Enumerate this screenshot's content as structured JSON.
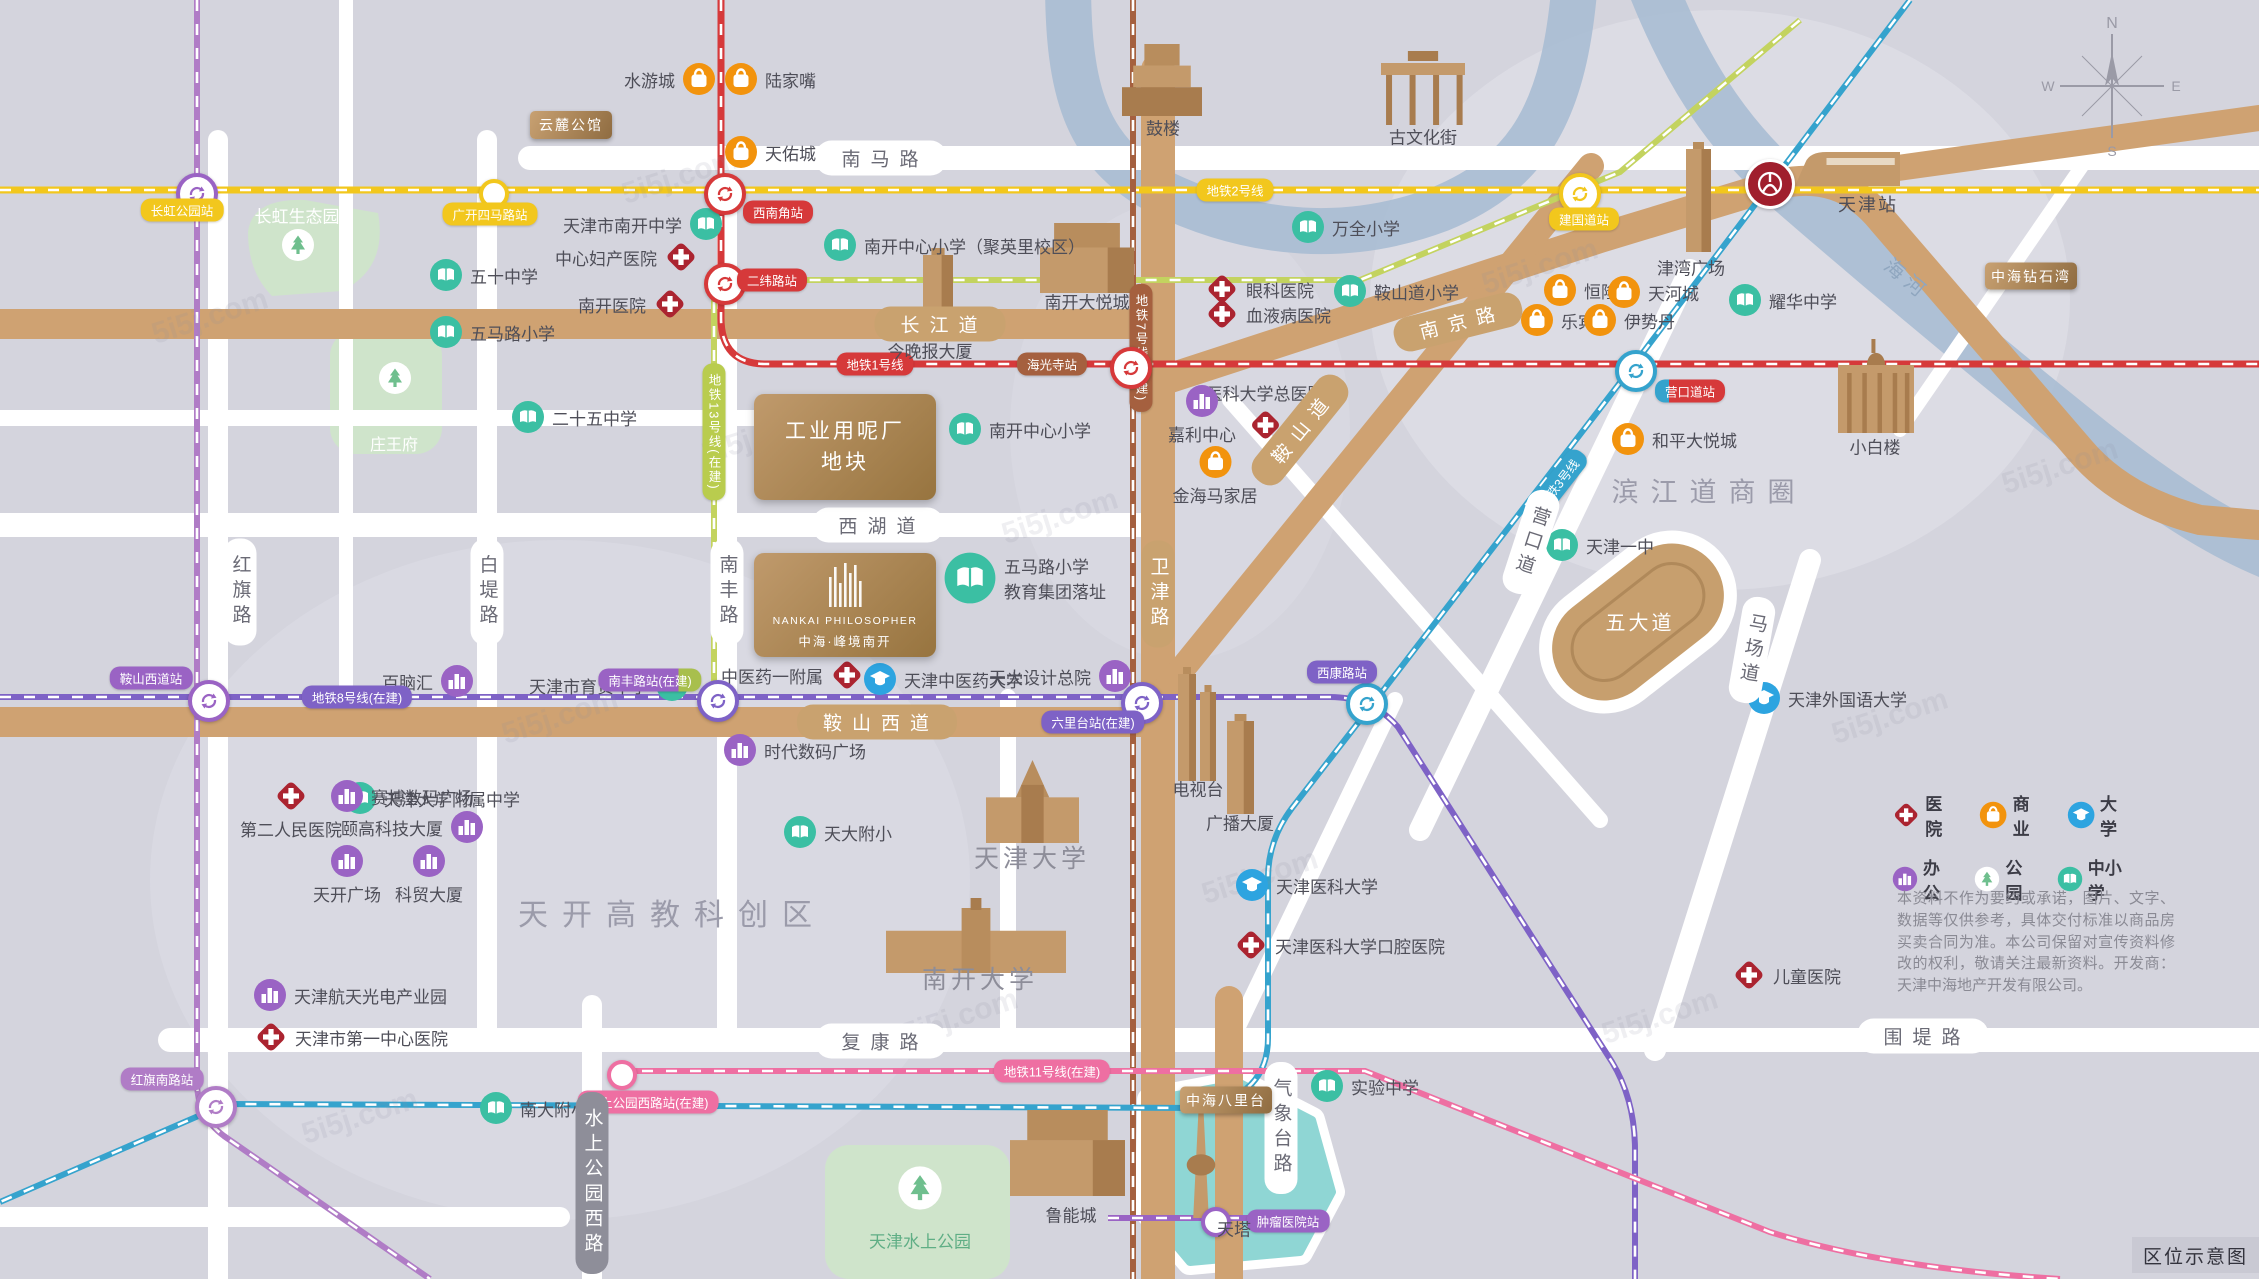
{
  "map": {
    "corner_label": "区位示意图",
    "watermark": "5i5j.com",
    "compass": {
      "x": 2112,
      "y": 86,
      "dirs": [
        "N",
        "W",
        "E",
        "S"
      ]
    },
    "legend": {
      "rows": [
        [
          {
            "icon": "hosp",
            "label": "医院"
          },
          {
            "icon": "shop",
            "label": "商业"
          },
          {
            "icon": "univ",
            "label": "大学"
          }
        ],
        [
          {
            "icon": "office",
            "label": "办公"
          },
          {
            "icon": "park",
            "label": "公园"
          },
          {
            "icon": "school",
            "label": "中小学"
          }
        ]
      ]
    },
    "disclaimer": "本资料不作为要约或承诺，图片、文字、数据等仅供参考，具体交付标准以商品房买卖合同为准。本公司保留对宣传资料修改的权利，敬请关注最新资料。开发商：天津中海地产开发有限公司。",
    "colors": {
      "line1": "#d6393a",
      "line2": "#f2c71d",
      "line3": "#35a3cd",
      "line7": "#a5603f",
      "line8": "#7e62c6",
      "line6": "#b07cc6",
      "line11": "#ee6fa2",
      "line13": "#b9cc4e",
      "school": "#3bbfa3",
      "univ": "#2da4e0",
      "hosp": "#ab2430",
      "office": "#9a63c4",
      "shop": "#f2930d",
      "tree": "#6fbf8e",
      "river": "#a9bdd3",
      "lake": "#8fd6d4",
      "road_tan": "#cfa272",
      "park": "#cfe4cb"
    },
    "metro_lines": [
      {
        "name": "line2",
        "color": "#f2c71d",
        "path": "M0,190 H2259",
        "w": 7
      },
      {
        "name": "line1",
        "color": "#d6393a",
        "path": "M721,0 V318 Q721,364 766,364 H2259",
        "w": 7
      },
      {
        "name": "line13",
        "color": "#c3d35f",
        "path": "M714,697 V300 Q714,280 740,280 H1360 L1620,172 L1800,20",
        "w": 6
      },
      {
        "name": "line7",
        "color": "#a5603f",
        "path": "M1133,0 V1279",
        "w": 6
      },
      {
        "name": "line8",
        "color": "#7e62c6",
        "path": "M0,697 H1330 Q1372,697 1398,727 L1612,1062 Q1635,1100 1635,1150 V1279",
        "w": 6
      },
      {
        "name": "line8b",
        "color": "#9a63c4",
        "path": "M1108,1218 H1290",
        "w": 6
      },
      {
        "name": "line6",
        "color": "#b07cc6",
        "path": "M197,0 V1082 Q197,1116 224,1136 L430,1279",
        "w": 6
      },
      {
        "name": "line3",
        "color": "#35a3cd",
        "path": "M1910,0 L1632,367 L1385,688 L1292,808 Q1268,840 1268,878 V1038 Q1268,1096 1200,1108 L226,1104 L0,1202",
        "w": 6
      },
      {
        "name": "line11",
        "color": "#ee6fa2",
        "path": "M618,1071 H1365 L1770,1232 Q1885,1268 2060,1279",
        "w": 6
      }
    ],
    "line_labels": [
      {
        "t": "地铁1号线",
        "x": 875,
        "y": 364,
        "bg": "#d6393a"
      },
      {
        "t": "地铁2号线",
        "x": 1235,
        "y": 190,
        "bg": "#f2c71d"
      },
      {
        "t": "地铁3号线",
        "x": 1558,
        "y": 483,
        "bg": "#35a3cd",
        "rot": -52
      },
      {
        "t": "地铁7号线(在建)",
        "x": 1141,
        "y": 348,
        "bg": "#a5603f",
        "v": 1
      },
      {
        "t": "地铁8号线(在建)",
        "x": 357,
        "y": 697,
        "bg": "#7e62c6"
      },
      {
        "t": "地铁11号线(在建)",
        "x": 1052,
        "y": 1071,
        "bg": "#ee6fa2"
      },
      {
        "t": "地铁13号线(在建)",
        "x": 714,
        "y": 432,
        "bg": "#b9cc4e",
        "v": 1
      }
    ],
    "stations": [
      {
        "x": 193,
        "y": 190,
        "k": "i",
        "c": "#9a63c4"
      },
      {
        "x": 490,
        "y": 190,
        "k": "p",
        "c": "#f2c71d"
      },
      {
        "x": 721,
        "y": 190,
        "k": "i",
        "c": "#d6393a"
      },
      {
        "x": 721,
        "y": 280,
        "k": "i",
        "c": "#d6393a"
      },
      {
        "x": 1576,
        "y": 190,
        "k": "i",
        "c": "#f2c71d"
      },
      {
        "x": 1127,
        "y": 364,
        "k": "i",
        "c": "#d6393a"
      },
      {
        "x": 1632,
        "y": 367,
        "k": "i",
        "c": "#35a3cd"
      },
      {
        "x": 205,
        "y": 697,
        "k": "i",
        "c": "#9a63c4"
      },
      {
        "x": 714,
        "y": 697,
        "k": "i",
        "c": "#7e62c6"
      },
      {
        "x": 1138,
        "y": 699,
        "k": "i",
        "c": "#7e62c6"
      },
      {
        "x": 1363,
        "y": 700,
        "k": "i",
        "c": "#35a3cd"
      },
      {
        "x": 212,
        "y": 1103,
        "k": "i",
        "c": "#b07cc6"
      },
      {
        "x": 618,
        "y": 1071,
        "k": "p",
        "c": "#ee6fa2"
      },
      {
        "x": 1212,
        "y": 1218,
        "k": "p",
        "c": "#9a63c4"
      },
      {
        "x": 1767,
        "y": 181,
        "k": "rail",
        "c": "#a01f2d"
      }
    ],
    "station_labels": [
      {
        "t": "长虹公园站",
        "x": 182,
        "y": 210,
        "bg": "#f2c71d"
      },
      {
        "t": "广开四马路站",
        "x": 490,
        "y": 214,
        "bg": "#f2c71d"
      },
      {
        "t": "西南角站",
        "x": 778,
        "y": 212,
        "bg": "#d6393a"
      },
      {
        "t": "二纬路站",
        "x": 772,
        "y": 280,
        "bg": "#d6393a"
      },
      {
        "t": "建国道站",
        "x": 1584,
        "y": 219,
        "bg": "#f2c71d"
      },
      {
        "t": "海光寺站",
        "x": 1052,
        "y": 364,
        "bg": "#a5603f"
      },
      {
        "t": "营口道站",
        "x": 1690,
        "y": 391,
        "bg": "linear-gradient(90deg,#35a3cd 0 20%,#d6393a 20%)"
      },
      {
        "t": "鞍山西道站",
        "x": 151,
        "y": 678,
        "bg": "#9a63c4"
      },
      {
        "t": "南丰路站(在建)",
        "x": 650,
        "y": 680,
        "bg": "linear-gradient(90deg,#9a63c4 0 78%,#a8bf4d 78%)"
      },
      {
        "t": "六里台站(在建)",
        "x": 1093,
        "y": 722,
        "bg": "#7e62c6"
      },
      {
        "t": "西康路站",
        "x": 1342,
        "y": 672,
        "bg": "#7e62c6"
      },
      {
        "t": "红旗南路站",
        "x": 162,
        "y": 1079,
        "bg": "#b07cc6"
      },
      {
        "t": "水上公园西路站(在建)",
        "x": 648,
        "y": 1102,
        "bg": "#ee6fa2"
      },
      {
        "t": "肿瘤医院站",
        "x": 1288,
        "y": 1221,
        "bg": "#9a63c4"
      },
      {
        "t": "天津站",
        "x": 1868,
        "y": 204,
        "bg": "none",
        "dark": 1
      }
    ],
    "road_labels": [
      {
        "t": "南马路",
        "x": 881,
        "y": 158,
        "k": "wh"
      },
      {
        "t": "西湖道",
        "x": 878,
        "y": 525,
        "k": "wh"
      },
      {
        "t": "复康路",
        "x": 881,
        "y": 1041,
        "k": "wh"
      },
      {
        "t": "围堤路",
        "x": 1923,
        "y": 1036,
        "k": "wh"
      },
      {
        "t": "红旗路",
        "x": 240,
        "y": 592,
        "k": "wv"
      },
      {
        "t": "白堤路",
        "x": 487,
        "y": 592,
        "k": "wv"
      },
      {
        "t": "南丰路",
        "x": 727,
        "y": 592,
        "k": "wv"
      },
      {
        "t": "营口道",
        "x": 1531,
        "y": 542,
        "k": "wv",
        "rot": 18
      },
      {
        "t": "马场道",
        "x": 1752,
        "y": 650,
        "k": "wv",
        "rot": 10
      },
      {
        "t": "气象台路",
        "x": 1281,
        "y": 1128,
        "k": "wv"
      },
      {
        "t": "水上公园西路",
        "x": 592,
        "y": 1183,
        "k": "gv"
      },
      {
        "t": "长江道",
        "x": 940,
        "y": 324,
        "k": "th"
      },
      {
        "t": "鞍山西道",
        "x": 877,
        "y": 722,
        "k": "th"
      },
      {
        "t": "南京路",
        "x": 1458,
        "y": 322,
        "k": "th",
        "rot": -14
      },
      {
        "t": "鞍山道",
        "x": 1300,
        "y": 430,
        "k": "th",
        "rot": -51
      },
      {
        "t": "卫津路",
        "x": 1158,
        "y": 594,
        "k": "tv"
      }
    ],
    "area_labels": [
      {
        "t": "天开高教科创区",
        "x": 672,
        "y": 912,
        "fs": 30,
        "c": "#9b9baa",
        "ls": 14
      },
      {
        "t": "滨江道商圈",
        "x": 1709,
        "y": 490,
        "fs": 27,
        "c": "#9b9baa",
        "ls": 12
      },
      {
        "t": "五大道",
        "x": 1640,
        "y": 621,
        "fs": 20,
        "c": "#ffffff",
        "ls": 3
      },
      {
        "t": "海河",
        "x": 1908,
        "y": 278,
        "fs": 20,
        "c": "#8fa6bf",
        "ls": 6,
        "rot": 40
      },
      {
        "t": "鼓楼",
        "x": 1163,
        "y": 127
      },
      {
        "t": "古文化街",
        "x": 1423,
        "y": 136
      },
      {
        "t": "南开大悦城",
        "x": 1087,
        "y": 301
      },
      {
        "t": "今晚报大厦",
        "x": 930,
        "y": 350
      },
      {
        "t": "津湾广场",
        "x": 1691,
        "y": 267
      },
      {
        "t": "小白楼",
        "x": 1875,
        "y": 446
      },
      {
        "t": "电视台",
        "x": 1198,
        "y": 788
      },
      {
        "t": "广播大厦",
        "x": 1240,
        "y": 822
      },
      {
        "t": "鲁能城",
        "x": 1071,
        "y": 1214
      },
      {
        "t": "天塔",
        "x": 1234,
        "y": 1228
      },
      {
        "t": "天津大学",
        "x": 1032,
        "y": 857,
        "fs": 25,
        "c": "#8d8d99",
        "ls": 4
      },
      {
        "t": "南开大学",
        "x": 980,
        "y": 978,
        "fs": 25,
        "c": "#8d8d99",
        "ls": 4
      },
      {
        "t": "长虹生态园",
        "x": 297,
        "y": 215,
        "c": "#ffffff"
      },
      {
        "t": "庄王府",
        "x": 394,
        "y": 443,
        "c": "#ffffff",
        "fs": 16
      },
      {
        "t": "天津水上公园",
        "x": 920,
        "y": 1240,
        "c": "#5fae85"
      }
    ],
    "pois": [
      {
        "tp": "school",
        "x": 446,
        "y": 275,
        "t": "五十中学",
        "s": "r"
      },
      {
        "tp": "school",
        "x": 446,
        "y": 332,
        "t": "五马路小学",
        "s": "r"
      },
      {
        "tp": "school",
        "x": 706,
        "y": 224,
        "t": "天津市南开中学",
        "s": "l"
      },
      {
        "tp": "school",
        "x": 840,
        "y": 245,
        "t": "南开中心小学（聚英里校区）",
        "s": "r"
      },
      {
        "tp": "school",
        "x": 528,
        "y": 417,
        "t": "二十五中学",
        "s": "r"
      },
      {
        "tp": "school",
        "x": 965,
        "y": 429,
        "t": "南开中心小学",
        "s": "r"
      },
      {
        "tp": "school",
        "x": 1308,
        "y": 227,
        "t": "万全小学",
        "s": "r"
      },
      {
        "tp": "school",
        "x": 1350,
        "y": 291,
        "t": "鞍山道小学",
        "s": "r"
      },
      {
        "tp": "school",
        "x": 1745,
        "y": 300,
        "t": "耀华中学",
        "s": "r"
      },
      {
        "tp": "school",
        "x": 1562,
        "y": 545,
        "t": "天津一中",
        "s": "r"
      },
      {
        "tp": "school",
        "x": 672,
        "y": 685,
        "t": "天津市育贤中学",
        "s": "l"
      },
      {
        "tp": "school",
        "x": 360,
        "y": 798,
        "t": "天津大学附属中学",
        "s": "r"
      },
      {
        "tp": "school",
        "x": 800,
        "y": 832,
        "t": "天大附小",
        "s": "r"
      },
      {
        "tp": "school",
        "x": 496,
        "y": 1108,
        "t": "南大附小",
        "s": "r"
      },
      {
        "tp": "school",
        "x": 1327,
        "y": 1086,
        "t": "实验中学",
        "s": "r"
      },
      {
        "tp": "school",
        "x": 970,
        "y": 578,
        "t": [
          "五马路小学",
          "教育集团落址"
        ],
        "s": "r",
        "big": 1
      },
      {
        "tp": "univ",
        "x": 880,
        "y": 679,
        "t": "天津中医药大学",
        "s": "r"
      },
      {
        "tp": "univ",
        "x": 1252,
        "y": 885,
        "t": "天津医科大学",
        "s": "r"
      },
      {
        "tp": "univ",
        "x": 1764,
        "y": 698,
        "t": "天津外国语大学",
        "s": "r"
      },
      {
        "tp": "hosp",
        "x": 681,
        "y": 257,
        "t": "中心妇产医院",
        "s": "l"
      },
      {
        "tp": "hosp",
        "x": 670,
        "y": 304,
        "t": "南开医院",
        "s": "l"
      },
      {
        "tp": "hosp",
        "x": 1222,
        "y": 289,
        "t": "眼科医院",
        "s": "r"
      },
      {
        "tp": "hosp",
        "x": 1222,
        "y": 314,
        "t": "血液病医院",
        "s": "r"
      },
      {
        "tp": "hosp",
        "x": 1265,
        "y": 423,
        "t": "医科大学总医院",
        "s": "a"
      },
      {
        "tp": "hosp",
        "x": 847,
        "y": 675,
        "t": "中医药一附属",
        "s": "l"
      },
      {
        "tp": "hosp",
        "x": 291,
        "y": 796,
        "t": "第二人民医院",
        "s": "b"
      },
      {
        "tp": "hosp",
        "x": 271,
        "y": 1037,
        "t": "天津市第一中心医院",
        "s": "r"
      },
      {
        "tp": "hosp",
        "x": 1251,
        "y": 945,
        "t": "天津医科大学口腔医院",
        "s": "r"
      },
      {
        "tp": "hosp",
        "x": 1749,
        "y": 975,
        "t": "儿童医院",
        "s": "r"
      },
      {
        "tp": "office",
        "x": 1202,
        "y": 401,
        "t": "嘉利中心",
        "s": "b"
      },
      {
        "tp": "office",
        "x": 457,
        "y": 681,
        "t": "百脑汇",
        "s": "l"
      },
      {
        "tp": "office",
        "x": 347,
        "y": 796,
        "t": "赛博数码广场",
        "s": "r"
      },
      {
        "tp": "office",
        "x": 467,
        "y": 827,
        "t": "颐高科技大厦",
        "s": "l"
      },
      {
        "tp": "office",
        "x": 740,
        "y": 750,
        "t": "时代数码广场",
        "s": "r"
      },
      {
        "tp": "office",
        "x": 347,
        "y": 861,
        "t": "天开广场",
        "s": "b"
      },
      {
        "tp": "office",
        "x": 429,
        "y": 861,
        "t": "科贸大厦",
        "s": "b"
      },
      {
        "tp": "office",
        "x": 270,
        "y": 995,
        "t": "天津航天光电产业园",
        "s": "r"
      },
      {
        "tp": "office",
        "x": 1115,
        "y": 676,
        "t": "天大设计总院",
        "s": "l"
      },
      {
        "tp": "shop",
        "x": 699,
        "y": 79,
        "t": "水游城",
        "s": "l"
      },
      {
        "tp": "shop",
        "x": 741,
        "y": 79,
        "t": "陆家嘴",
        "s": "r"
      },
      {
        "tp": "shop",
        "x": 741,
        "y": 152,
        "t": "天佑城",
        "s": "r"
      },
      {
        "tp": "shop",
        "x": 1560,
        "y": 290,
        "t": "恒隆",
        "s": "r"
      },
      {
        "tp": "shop",
        "x": 1624,
        "y": 292,
        "t": "天河城",
        "s": "r"
      },
      {
        "tp": "shop",
        "x": 1537,
        "y": 320,
        "t": "乐宾",
        "s": "r"
      },
      {
        "tp": "shop",
        "x": 1600,
        "y": 320,
        "t": "伊势丹",
        "s": "r"
      },
      {
        "tp": "shop",
        "x": 1628,
        "y": 439,
        "t": "和平大悦城",
        "s": "r"
      },
      {
        "tp": "shop",
        "x": 1215,
        "y": 462,
        "t": "金海马家居",
        "s": "b"
      },
      {
        "tp": "park",
        "x": 298,
        "y": 245,
        "t": "",
        "s": "r"
      },
      {
        "tp": "park",
        "x": 395,
        "y": 378,
        "t": "",
        "s": "r"
      },
      {
        "tp": "park",
        "x": 920,
        "y": 1188,
        "t": "",
        "s": "r",
        "big": 1
      }
    ],
    "projects": [
      {
        "t": "云麓公馆",
        "x": 571,
        "y": 125,
        "w": 82,
        "h": 28,
        "kind": "badge"
      },
      {
        "t": "中海钻石湾",
        "x": 2031,
        "y": 276,
        "w": 92,
        "h": 27,
        "kind": "badge"
      },
      {
        "t": "中海八里台",
        "x": 1226,
        "y": 1100,
        "w": 92,
        "h": 27,
        "kind": "badge"
      },
      {
        "lines": [
          "工业用呢厂",
          "地块"
        ],
        "x": 754,
        "y": 394,
        "w": 182,
        "h": 106,
        "kind": "block"
      },
      {
        "lines": [
          "NANKAI PHILOSOPHER",
          "中海·峰境南开"
        ],
        "x": 754,
        "y": 553,
        "w": 182,
        "h": 104,
        "kind": "logo"
      }
    ]
  }
}
